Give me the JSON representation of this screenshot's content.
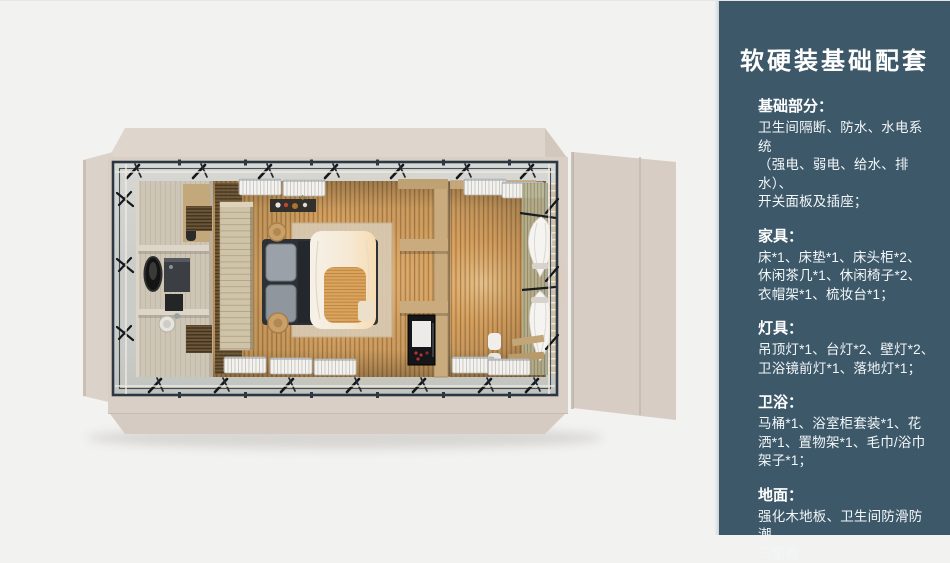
{
  "panel": {
    "title": "软硬装基础配套",
    "sections": [
      {
        "heading": "基础部分：",
        "body": "卫生间隔断、防水、水电系统\n（强电、弱电、给水、排水）、\n开关面板及插座；"
      },
      {
        "heading": "家具：",
        "body": "床*1、床垫*1、床头柜*2、\n休闲茶几*1、休闲椅子*2、\n衣帽架*1、梳妆台*1；"
      },
      {
        "heading": "灯具：",
        "body": "吊顶灯*1、台灯*2、壁灯*2、\n卫浴镜前灯*1、落地灯*1；"
      },
      {
        "heading": "卫浴：",
        "body": "马桶*1、浴室柜套装*1、花\n洒*1、置物架*1、毛巾/浴巾\n架子*1；"
      },
      {
        "heading": "地面：",
        "body": "强化木地板、卫生间防滑防潮\n石塑板；"
      }
    ]
  },
  "floorplan": {
    "palette": {
      "page_bg": "#f2f2f1",
      "panel_bg": "#3d5869",
      "wall_beige": "#d9cfc6",
      "deck_gray": "#c7c9c4",
      "frame_navy": "#2b3844",
      "floor_wood": "#c3955a",
      "floor_glow": "#f5c27a",
      "bathroom_tile": "#cdc5b6",
      "accent_wood": "#c9ab7e",
      "duvet_white": "#f4eee6"
    }
  }
}
